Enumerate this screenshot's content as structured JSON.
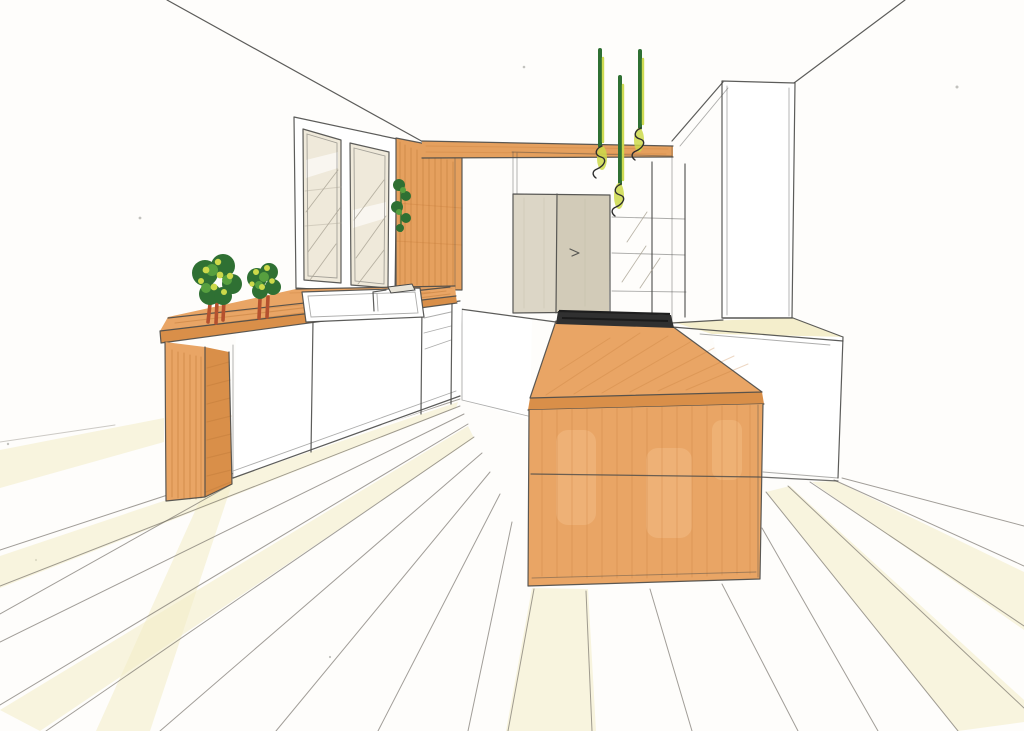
{
  "document": {
    "title": "Hand-drawn kitchen interior perspective sketch",
    "medium": "ink line drawing with marker coloring on white paper"
  },
  "palette": {
    "paper": "#fefdfb",
    "line": "#4a4a48",
    "floor_line": "#6f6a62",
    "wood": "#e9a565",
    "wood_mid": "#e5a05e",
    "wood_deep": "#d98f49",
    "wood_dark": "#c27c39",
    "wood_light": "#f4c28c",
    "green_dark": "#2f7033",
    "green_mid": "#57a03f",
    "green_yellow": "#ccd94a",
    "trunk": "#b5512e",
    "beige": "#dcd6c6",
    "beige_dark": "#d2cbb8",
    "cream": "#f3ecc6",
    "glass": "#efe9da",
    "cooktop": "#303030"
  },
  "scene": {
    "elements": [
      "ceiling-lines",
      "floor-planks",
      "window",
      "wall-plant",
      "wood-wall-panel",
      "ceiling-beam",
      "refrigerator",
      "open-shelves",
      "tall-cabinet",
      "right-counter",
      "base-cabinets",
      "sink-counter",
      "sink",
      "faucet",
      "bar-counter",
      "bar-leg",
      "potted-tree",
      "kitchen-island",
      "cooktop",
      "pendant-lights"
    ]
  }
}
